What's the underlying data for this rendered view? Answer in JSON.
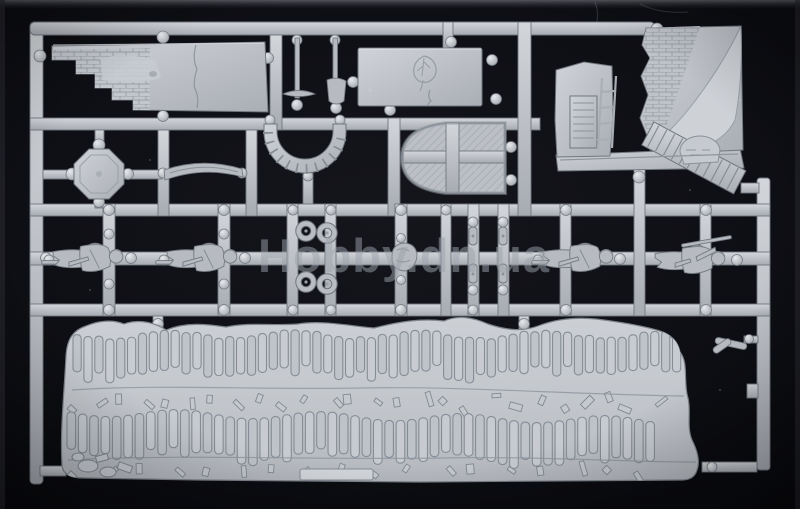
{
  "photo": {
    "watermark": {
      "text": "Hobby.dn.ua"
    },
    "colors": {
      "background": "#0d0e13",
      "background_center": "#15161c",
      "plastic_light": "#d8dbdf",
      "plastic_mid": "#b2b6bc",
      "plastic_dark": "#878c93",
      "outline": "#70757d",
      "base_light": "#ccd0d5",
      "base_mid": "#b9bdc3",
      "watermark_color": "#9ca1ac"
    },
    "sprue": {
      "figure_count": 4,
      "parts": [
        {
          "name": "ruined-wall-section"
        },
        {
          "name": "wall-panel-with-emblem"
        },
        {
          "name": "pickaxe-tool"
        },
        {
          "name": "shovel-tool"
        },
        {
          "name": "arch-segment"
        },
        {
          "name": "arched-door"
        },
        {
          "name": "ruined-building-corner"
        },
        {
          "name": "octagonal-hatch"
        },
        {
          "name": "wooden-beam"
        },
        {
          "name": "wheel-set"
        },
        {
          "name": "soldier-figures"
        },
        {
          "name": "equipment-posts"
        },
        {
          "name": "sandbag-trench-base"
        }
      ]
    },
    "base_texture": {
      "sandbags_top_count": 56,
      "sandbags_bottom_count": 52,
      "debris_mid_count": 26,
      "debris_bottom_count": 18
    }
  }
}
